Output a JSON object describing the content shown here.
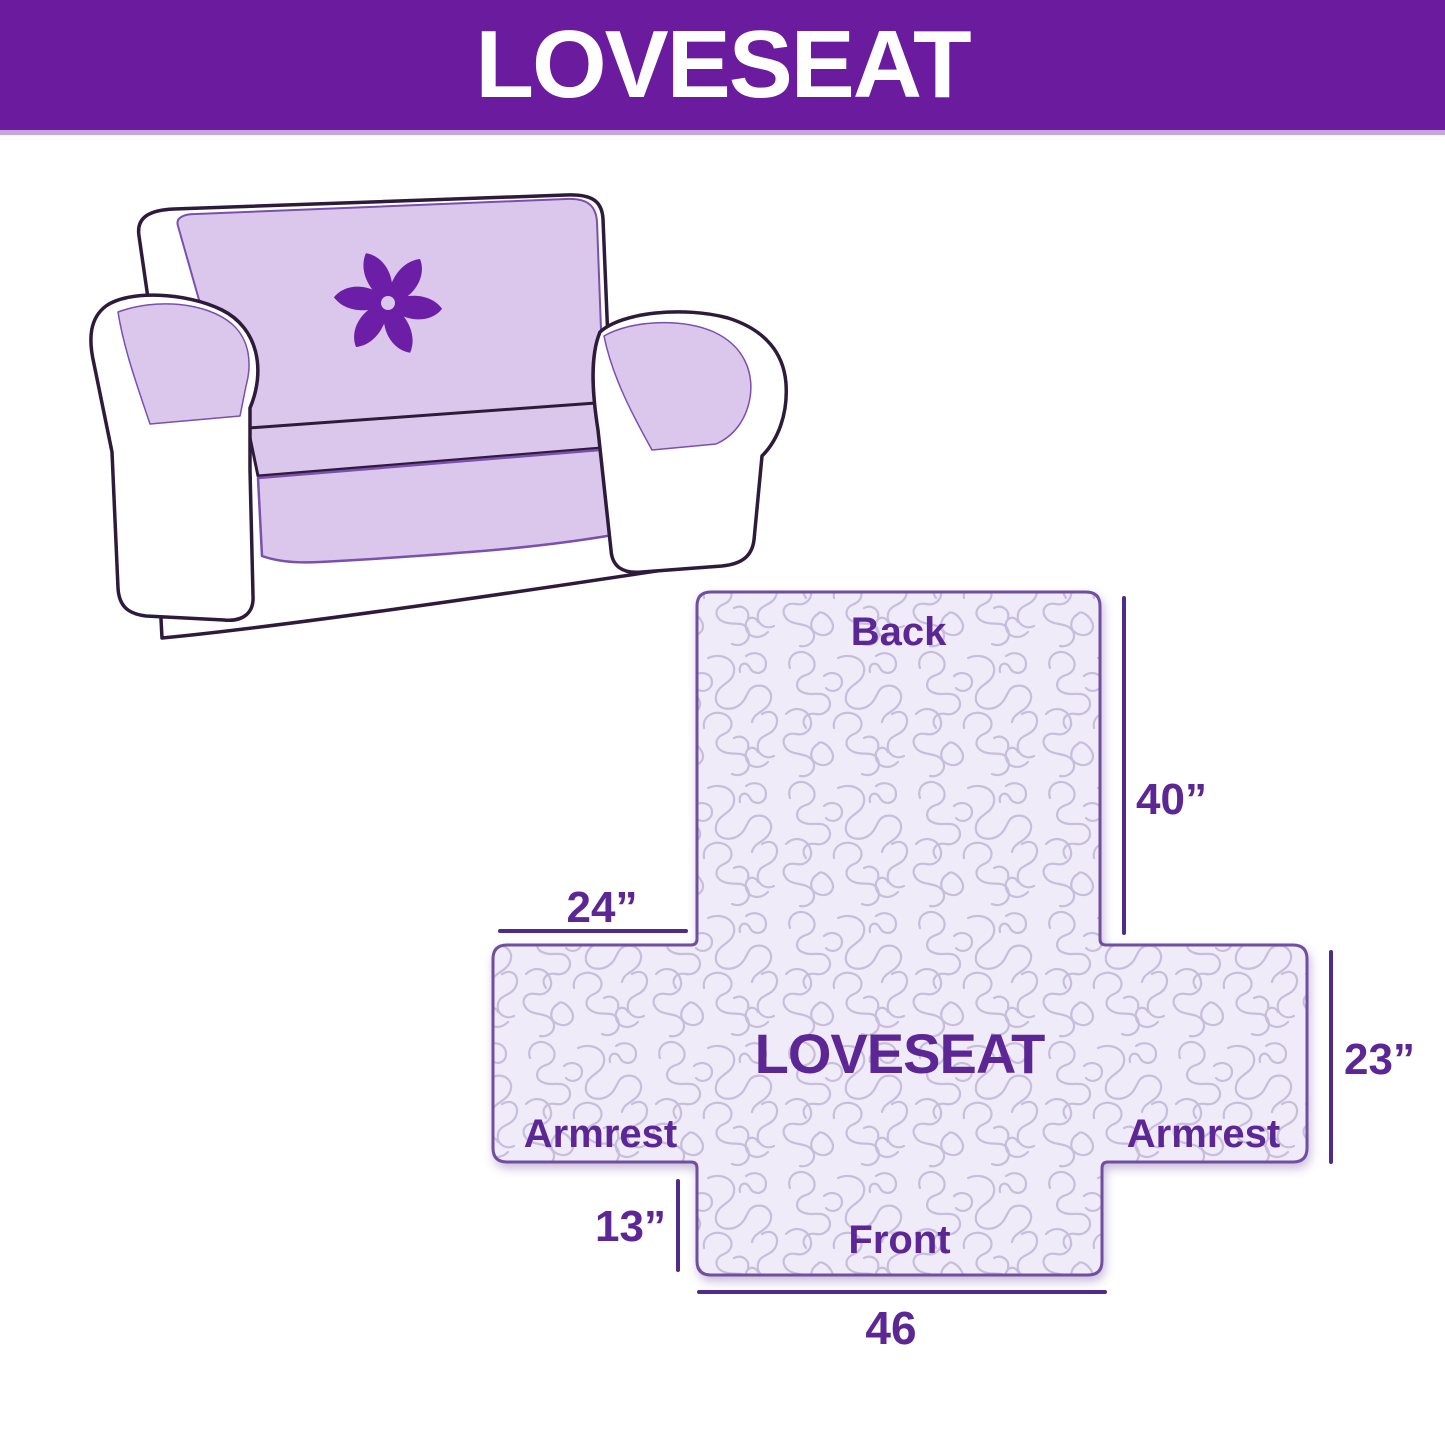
{
  "header": {
    "title": "LOVESEAT"
  },
  "sofa": {
    "logo_icon": "pinwheel-logo-icon"
  },
  "diagram": {
    "center_label": "LOVESEAT",
    "back_label": "Back",
    "front_label": "Front",
    "armrest_left_label": "Armrest",
    "armrest_right_label": "Armrest",
    "dimensions": {
      "back_height": "40”",
      "armrest_top_width": "24”",
      "armrest_side_height": "23”",
      "front_drop": "13”",
      "front_width": "46"
    }
  },
  "colors": {
    "header_background": "#6b1c9e",
    "header_text": "#ffffff",
    "header_underline": "#c7a3df",
    "label_text": "#5c2795",
    "dimension_line": "#4f2b8a",
    "cover_fill": "#efebf8",
    "cover_texture_line": "#c8bedb",
    "cover_outline": "#7050a0",
    "sofa_cover": "#dbc7eb",
    "sofa_cover_edge": "#7a4fae",
    "sofa_outline": "#2e1a3b",
    "pinwheel": "#6c1fa6"
  }
}
